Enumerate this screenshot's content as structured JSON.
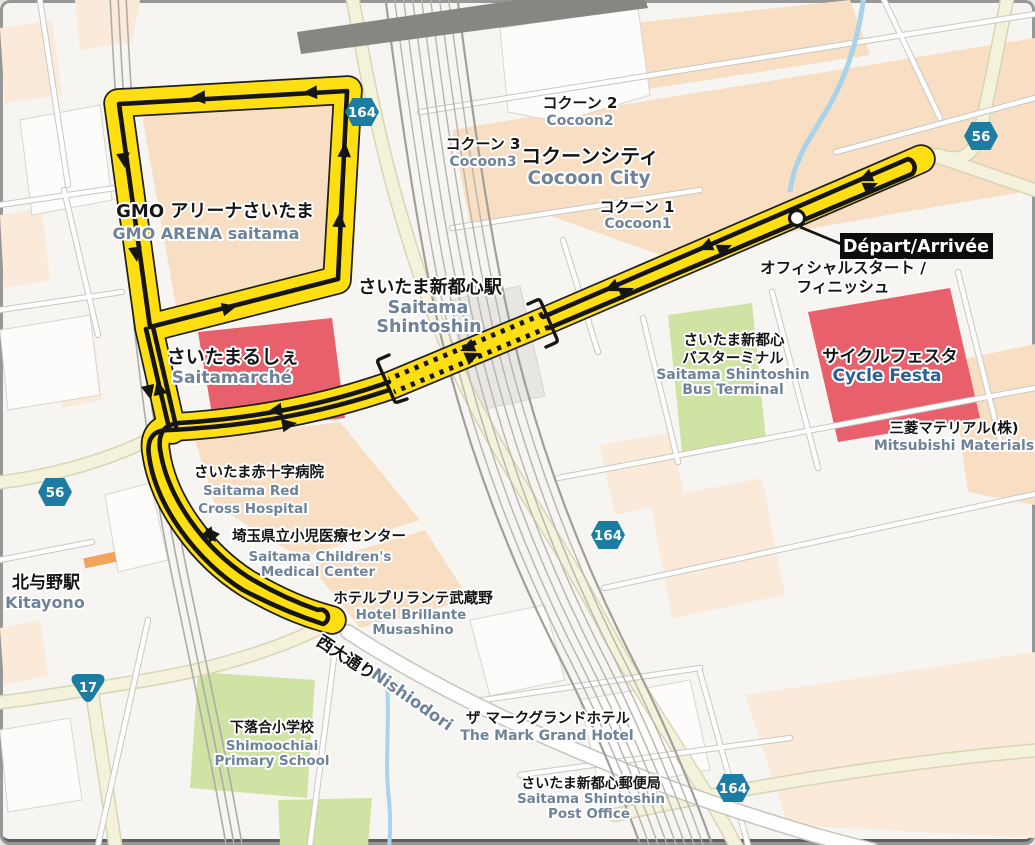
{
  "places": {
    "gmo_arena": {
      "jp": "GMO アリーナさいたま",
      "en": "GMO ARENA saitama"
    },
    "cocoon2": {
      "jp": "コクーン 2",
      "en": "Cocoon2"
    },
    "cocoon3": {
      "jp": "コクーン 3",
      "en": "Cocoon3"
    },
    "cocoon_city": {
      "jp": "コクーンシティ",
      "en": "Cocoon City"
    },
    "cocoon1": {
      "jp": "コクーン 1",
      "en": "Cocoon1"
    },
    "station": {
      "jp": "さいたま新都心駅",
      "en_line1": "Saitama",
      "en_line2": "Shintoshin"
    },
    "saitamarche": {
      "jp": "さいたまるしぇ",
      "en": "Saitamarché"
    },
    "bus_terminal": {
      "jp_line1": "さいたま新都心",
      "jp_line2": "バスターミナル",
      "en_line1": "Saitama Shintoshin",
      "en_line2": "Bus Terminal"
    },
    "cycle_festa": {
      "jp": "サイクルフェスタ",
      "en": "Cycle Festa"
    },
    "mitsubishi": {
      "jp": "三菱マテリアル(株)",
      "en": "Mitsubishi Materials"
    },
    "red_cross": {
      "jp": "さいたま赤十字病院",
      "en_line1": "Saitama Red",
      "en_line2": "Cross Hospital"
    },
    "childrens_medical": {
      "jp": "埼玉県立小児医療センター",
      "en_line1": "Saitama Children's",
      "en_line2": "Medical Center"
    },
    "hotel_brillante": {
      "jp": "ホテルブリランテ武蔵野",
      "en_line1": "Hotel Brillante",
      "en_line2": "Musashino"
    },
    "kitayono": {
      "jp": "北与野駅",
      "en": "Kitayono"
    },
    "nishiodori": {
      "jp": "西大通り",
      "en": "Nishiodori"
    },
    "shimoochiai": {
      "jp": "下落合小学校",
      "en_line1": "Shimoochiai",
      "en_line2": "Primary School"
    },
    "mark_grand": {
      "jp": "ザ マークグランドホテル",
      "en": "The Mark Grand Hotel"
    },
    "post_office": {
      "jp": "さいたま新都心郵便局",
      "en_line1": "Saitama Shintoshin",
      "en_line2": "Post Office"
    }
  },
  "start_finish": {
    "label": "Départ/Arrivée",
    "jp_line1": "オフィシャルスタート /",
    "jp_line2": "フィニッシュ"
  },
  "road_badges": {
    "r164": "164",
    "r56": "56",
    "r17": "17"
  },
  "colors": {
    "route": "#ffdf12",
    "route_casing": "#1f1f1f",
    "badge_blue": "#1d7ca1",
    "red_block": "#e8606b",
    "green_block": "#cfe3a4",
    "peach_block": "#f8dfc3",
    "water": "#a9d3ea"
  }
}
